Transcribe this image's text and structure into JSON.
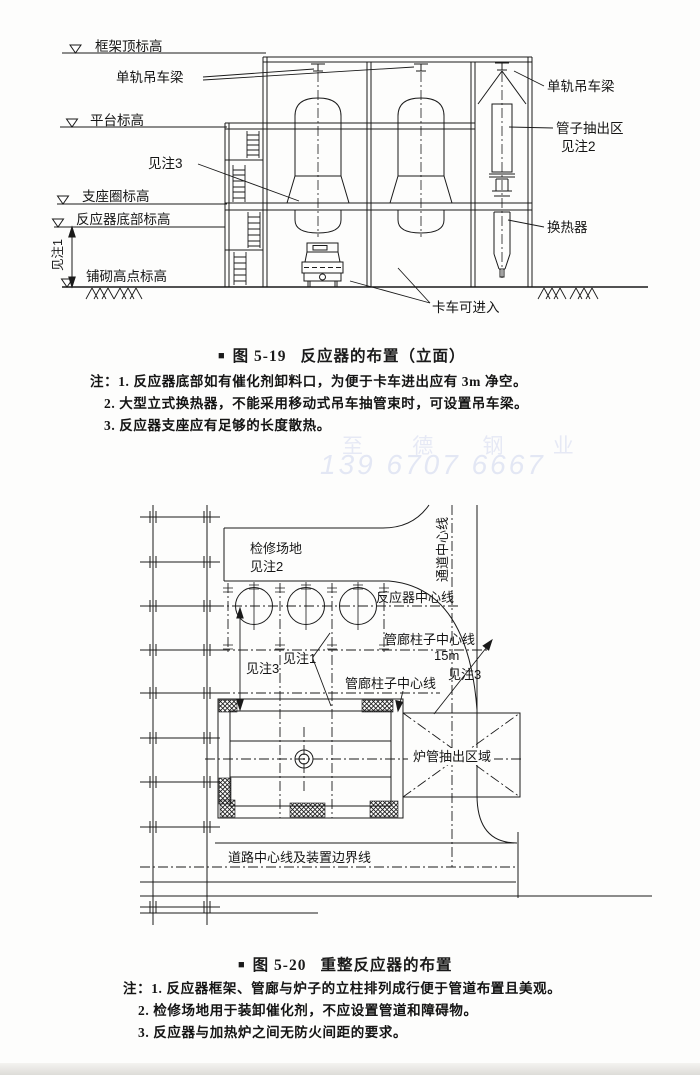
{
  "ink_color": "#1a1a1a",
  "watermark": {
    "line1": "至 德 钢 业",
    "line2": "139 6707 6667",
    "color": "#e6e9f5"
  },
  "fig1": {
    "labels": {
      "frame_top": "框架顶标高",
      "monorail_left": "单轨吊车梁",
      "platform": "平台标高",
      "see_note3": "见注3",
      "support_ring": "支座圈标高",
      "reactor_bottom": "反应器底部标高",
      "see_note1": "见注1",
      "paving_high": "铺砌高点标高",
      "monorail_right": "单轨吊车梁",
      "tube_pull_zone": "管子抽出区",
      "tube_pull_note": "见注2",
      "exchanger": "换热器",
      "truck_access": "卡车可进入"
    },
    "caption": {
      "bullet": "■",
      "num": "图 5-19",
      "title": "反应器的布置（立面）"
    },
    "notes": [
      "注：1. 反应器底部如有催化剂卸料口，为便于卡车进出应有 3m 净空。",
      "2. 大型立式换热器，不能采用移动式吊车抽管束时，可设置吊车梁。",
      "3. 反应器支座应有足够的长度散热。"
    ]
  },
  "fig2": {
    "labels": {
      "maint_area": "检修场地",
      "maint_note": "见注2",
      "aisle_cl": "通道中心线",
      "reactor_cl": "反应器中心线",
      "piperack_cl_upper": "管廊柱子中心线",
      "dim_15m": "15m",
      "see_note3_right": "见注3",
      "see_note1": "见注1",
      "see_note3_left": "见注3",
      "piperack_cl_lower": "管廊柱子中心线",
      "furnace_tube_zone": "炉管抽出区域",
      "road_cl": "道路中心线及装置边界线"
    },
    "caption": {
      "bullet": "■",
      "num": "图 5-20",
      "title": "重整反应器的布置"
    },
    "notes": [
      "注：1. 反应器框架、管廊与炉子的立柱排列成行便于管道布置且美观。",
      "2. 检修场地用于装卸催化剂，不应设置管道和障碍物。",
      "3. 反应器与加热炉之间无防火间距的要求。"
    ]
  }
}
